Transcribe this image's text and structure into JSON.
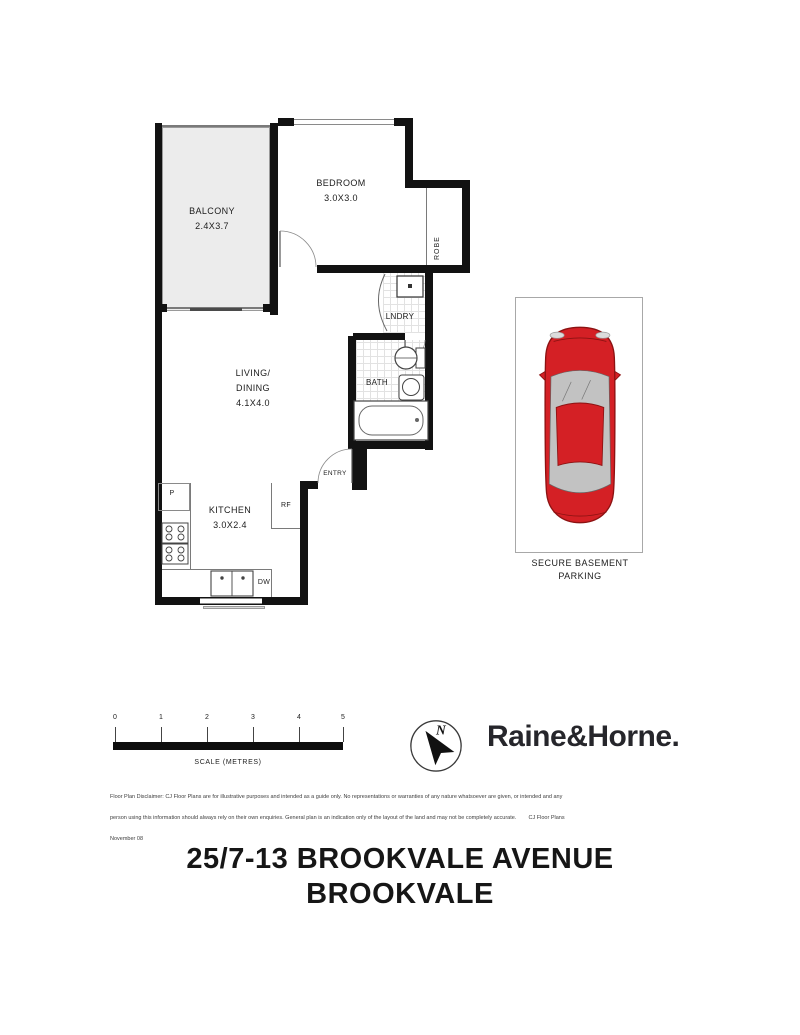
{
  "floor_plan": {
    "balcony": {
      "name": "BALCONY",
      "dims": "2.4X3.7"
    },
    "bedroom": {
      "name": "BEDROOM",
      "dims": "3.0X3.0"
    },
    "robe": {
      "name": "ROBE"
    },
    "laundry": {
      "name": "LNDRY"
    },
    "bath": {
      "name": "BATH"
    },
    "living": {
      "name_line1": "LIVING/",
      "name_line2": "DINING",
      "dims": "4.1X4.0"
    },
    "entry": {
      "name": "ENTRY"
    },
    "kitchen": {
      "name": "KITCHEN",
      "dims": "3.0X2.4",
      "pantry": "P",
      "fridge": "RF",
      "dishwasher": "DW"
    }
  },
  "parking": {
    "line1": "SECURE BASEMENT",
    "line2": "PARKING"
  },
  "scale_bar": {
    "ticks": [
      "0",
      "1",
      "2",
      "3",
      "4",
      "5"
    ],
    "caption": "SCALE (METRES)"
  },
  "compass": {
    "north": "N"
  },
  "brand": {
    "logo_text": "Raine&Horne."
  },
  "disclaimer": {
    "line1": "Floor Plan Disclaimer: CJ Floor Plans are for illustrative purposes and intended as a guide only. No representations or warranties of any nature whatsoever are given, or intended and any",
    "line2": "person using this information should always rely on their own enquiries. General plan is an indication only of the layout of the land and may not be completely accurate.        CJ Floor Plans",
    "line3": "November 08"
  },
  "address": {
    "line1": "25/7-13 BROOKVALE AVENUE",
    "line2": "BROOKVALE"
  },
  "colors": {
    "wall": "#121212",
    "car_body": "#d42025",
    "car_glass": "#c2c2c2",
    "logo_text": "#26262b"
  }
}
